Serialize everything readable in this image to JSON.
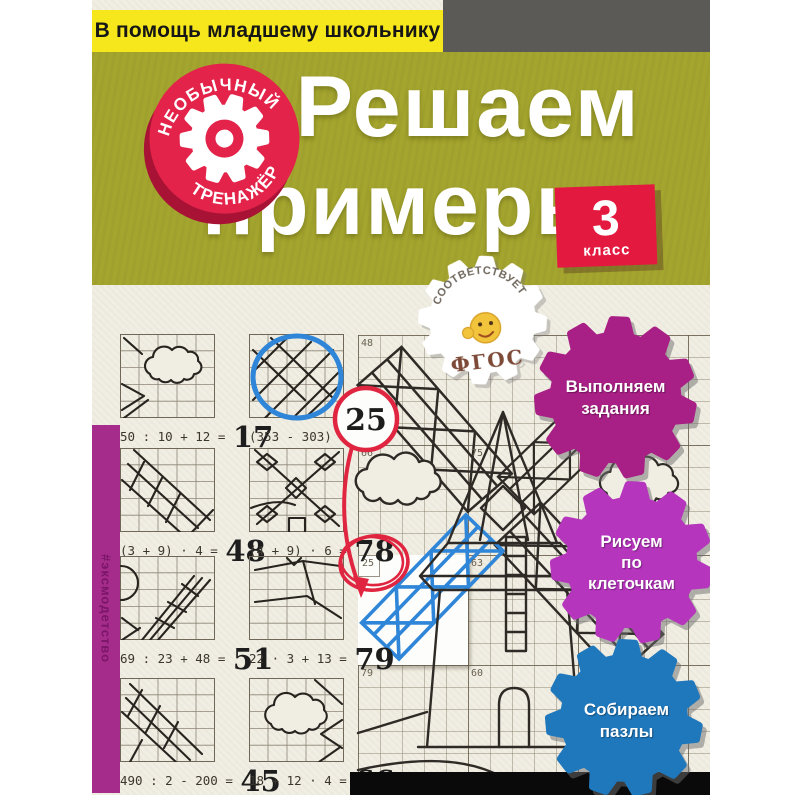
{
  "banner": "В помощь младшему школьнику",
  "hashtag": "#эксмодетство",
  "stamp": {
    "arc_top": "НЕОБЫЧНЫЙ",
    "arc_bottom": "ТРЕНАЖЁР"
  },
  "title": {
    "line1": "Решаем",
    "line2": "примеры"
  },
  "grade": {
    "number": "3",
    "label": "класс"
  },
  "fgos": {
    "arc": "СООТВЕТСТВУЕТ",
    "label": "ФГОС"
  },
  "features": [
    {
      "color": "#a81f85",
      "lines": [
        "Выполняем",
        "задания"
      ]
    },
    {
      "color": "#b535bd",
      "lines": [
        "Рисуем",
        "по",
        "клеточкам"
      ]
    },
    {
      "color": "#1f78bc",
      "lines": [
        "Собираем",
        "пазлы"
      ]
    }
  ],
  "examples": [
    {
      "expr": "50 : 10 + 12 =",
      "answer": "17"
    },
    {
      "expr": "(353 - 303) : 2 =",
      "answer": ""
    },
    {
      "expr": "(3 + 9) · 4 =",
      "answer": "48"
    },
    {
      "expr": "(4 + 9) · 6 =",
      "answer": "78"
    },
    {
      "expr": "69 : 23 + 48 =",
      "answer": "51"
    },
    {
      "expr": "22 · 3 + 13 =",
      "answer": "79"
    },
    {
      "expr": "490 : 2 - 200 =",
      "answer": "45"
    },
    {
      "expr": "18 + 12 · 4 =",
      "answer": "66"
    }
  ],
  "grid_labels": [
    "48",
    "66",
    "75",
    "17",
    "25",
    "63",
    "79",
    "60"
  ],
  "annotations": {
    "circled_answer": "25"
  },
  "colors": {
    "banner_yellow": "#f6e71c",
    "header_olive": "#a4a52e",
    "top_gray": "#5b5a56",
    "stamp_red": "#e3234a",
    "grade_red": "#e41940",
    "spine_magenta": "#a62c8c",
    "pen_blue": "#2f86d8",
    "pen_red": "#e02540",
    "black_band": "#0a0a0a"
  }
}
